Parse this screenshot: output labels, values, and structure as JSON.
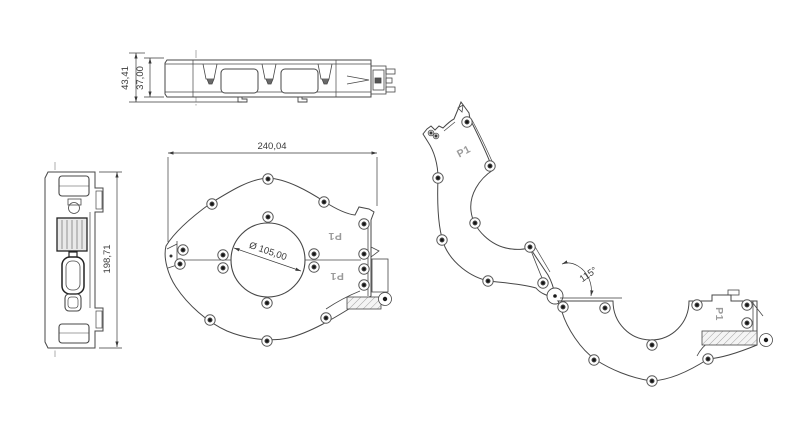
{
  "drawing": {
    "background": "#ffffff",
    "line_color": "#474747",
    "dim_text_color": "#3a3a3a",
    "part_label_color": "#9a9a9a",
    "dimensions": {
      "top_view_height_outer": "43,41",
      "top_view_height_inner": "37,00",
      "side_view_height": "198,71",
      "front_view_width": "240,04",
      "front_view_bore_diameter": "Ø 105,00",
      "open_view_angle": "115°"
    },
    "part_labels": {
      "front_upper": "P1",
      "front_lower": "P1",
      "open_upper": "P1",
      "open_lower": "P1"
    }
  }
}
